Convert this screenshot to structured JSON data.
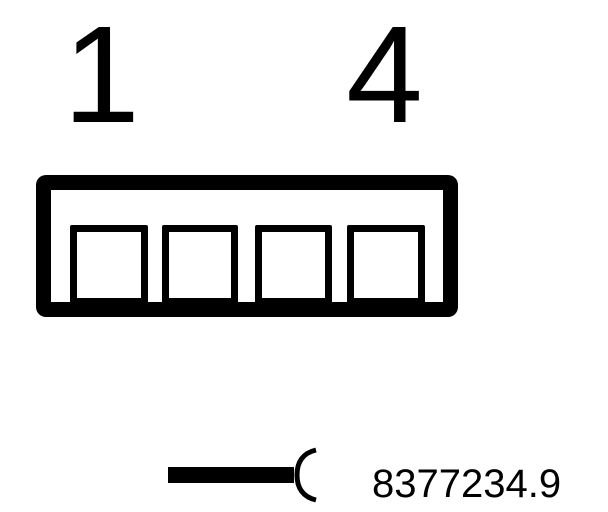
{
  "colors": {
    "background": "#ffffff",
    "ink": "#000000"
  },
  "connector": {
    "pin_count": 4,
    "pin_start_label": "1",
    "pin_end_label": "4"
  },
  "legend": {
    "symbol_icon": "wire-end-open-socket-icon",
    "part_number": "8377234.9"
  }
}
